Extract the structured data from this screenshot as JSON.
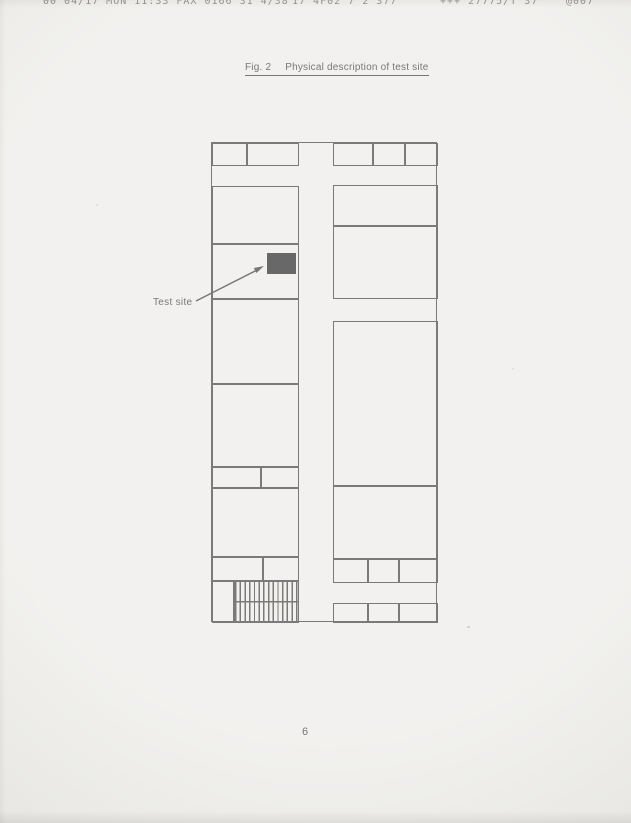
{
  "page": {
    "number": "6",
    "colors": {
      "paper": "#ebeae6",
      "ink": "#34332f",
      "marker": "#171717",
      "faded_header_ink": "#56544f"
    }
  },
  "fax_header": {
    "segments": [
      "00 04/17 MON 11:33 FAX 0166 31 4/38",
      "17 4F02 7 2 377",
      "+++ 27775/T 37",
      "@007"
    ]
  },
  "figure": {
    "label": "Fig. 2",
    "title": "Physical description of test site",
    "annotation_label": "Test site"
  },
  "floor_plan": {
    "outer": {
      "x": 211,
      "y": 142,
      "w": 226,
      "h": 480
    },
    "corridor_width": 34,
    "test_site_marker": {
      "x": 55,
      "y": 110,
      "w": 29,
      "h": 21
    },
    "rooms": [
      {
        "name": "top-left-cell-1",
        "x": 0,
        "y": 0,
        "w": 35,
        "h": 23
      },
      {
        "name": "top-left-cell-2",
        "x": 35,
        "y": 0,
        "w": 52,
        "h": 23
      },
      {
        "name": "left-room-1",
        "x": 0,
        "y": 43,
        "w": 87,
        "h": 58
      },
      {
        "name": "test-site-room",
        "x": 0,
        "y": 101,
        "w": 87,
        "h": 55
      },
      {
        "name": "left-room-2",
        "x": 0,
        "y": 156,
        "w": 87,
        "h": 85
      },
      {
        "name": "left-room-3",
        "x": 0,
        "y": 241,
        "w": 87,
        "h": 83
      },
      {
        "name": "left-annex-cell-1",
        "x": 0,
        "y": 324,
        "w": 49,
        "h": 21
      },
      {
        "name": "left-annex-cell-2",
        "x": 49,
        "y": 324,
        "w": 38,
        "h": 21
      },
      {
        "name": "left-room-4",
        "x": 0,
        "y": 345,
        "w": 87,
        "h": 69
      },
      {
        "name": "left-annex-cell-3",
        "x": 0,
        "y": 414,
        "w": 51,
        "h": 24
      },
      {
        "name": "left-annex-cell-4",
        "x": 51,
        "y": 414,
        "w": 36,
        "h": 24
      },
      {
        "name": "stair-lobby",
        "x": 0,
        "y": 438,
        "w": 22,
        "h": 42
      },
      {
        "name": "stairs",
        "x": 22,
        "y": 438,
        "w": 65,
        "h": 42,
        "type": "stairs"
      },
      {
        "name": "top-right-cell-1",
        "x": 121,
        "y": 0,
        "w": 40,
        "h": 23
      },
      {
        "name": "top-right-cell-2",
        "x": 161,
        "y": 0,
        "w": 32,
        "h": 23
      },
      {
        "name": "top-right-cell-3",
        "x": 193,
        "y": 0,
        "w": 33,
        "h": 23
      },
      {
        "name": "right-room-1",
        "x": 121,
        "y": 42,
        "w": 105,
        "h": 41
      },
      {
        "name": "right-room-2",
        "x": 121,
        "y": 83,
        "w": 105,
        "h": 73
      },
      {
        "name": "right-room-3",
        "x": 121,
        "y": 178,
        "w": 105,
        "h": 165
      },
      {
        "name": "right-room-4",
        "x": 121,
        "y": 343,
        "w": 105,
        "h": 73
      },
      {
        "name": "right-annex-cell-1",
        "x": 121,
        "y": 416,
        "w": 35,
        "h": 24
      },
      {
        "name": "right-annex-cell-2",
        "x": 156,
        "y": 416,
        "w": 31,
        "h": 24
      },
      {
        "name": "right-annex-cell-3",
        "x": 187,
        "y": 416,
        "w": 39,
        "h": 24
      },
      {
        "name": "right-bottom-cell-1",
        "x": 121,
        "y": 460,
        "w": 35,
        "h": 20
      },
      {
        "name": "right-bottom-cell-2",
        "x": 156,
        "y": 460,
        "w": 31,
        "h": 20
      },
      {
        "name": "right-bottom-cell-3",
        "x": 187,
        "y": 460,
        "w": 39,
        "h": 20
      }
    ]
  }
}
